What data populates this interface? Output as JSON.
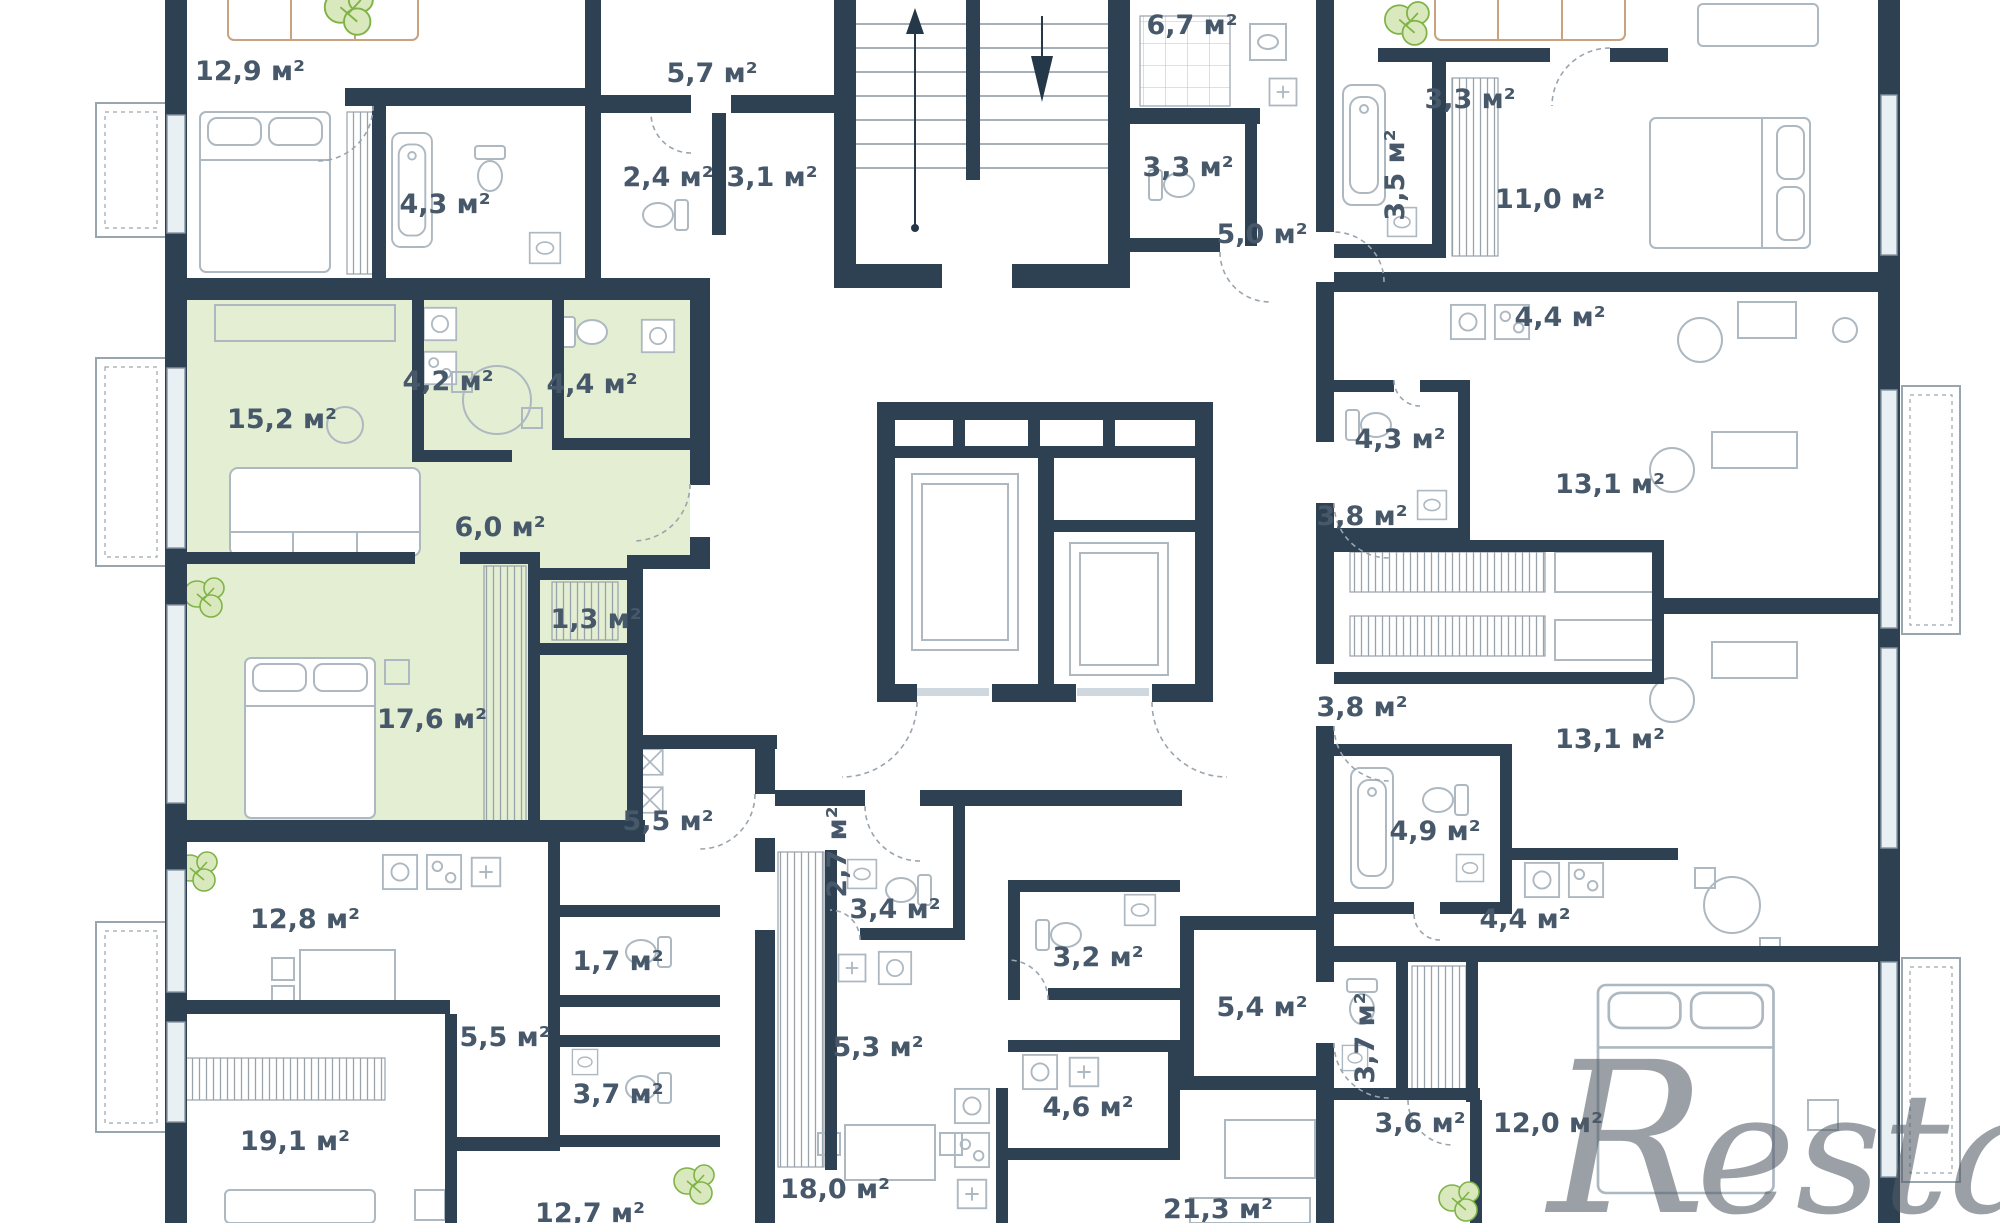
{
  "title": "Residential floor plan",
  "area_unit": "м²",
  "watermark": {
    "r": "R",
    "rest": "estate"
  },
  "colors": {
    "wall": "#2d4152",
    "highlight_apartment": "#e4eed2",
    "label_text": "#46586a",
    "plant_green": "#7fb347",
    "watermark_grey": "#525c66"
  },
  "icons": [
    "plant-icon",
    "stairs-up-arrow-icon",
    "stairs-down-arrow-icon",
    "toilet-icon",
    "sink-icon",
    "washer-icon",
    "stove-icon",
    "bathtub-icon"
  ],
  "rooms": [
    {
      "name": "bedroom-top-left",
      "area": "12,9 м²"
    },
    {
      "name": "hallway-top-left",
      "area": "5,7 м²"
    },
    {
      "name": "bathroom-top-center",
      "area": "6,7 м²"
    },
    {
      "name": "hallway-top-right",
      "area": "3,3 м²"
    },
    {
      "name": "wc-top-left",
      "area": "2,4 м²"
    },
    {
      "name": "hall-top-left",
      "area": "3,1 м²"
    },
    {
      "name": "wc-top-center",
      "area": "3,3 м²"
    },
    {
      "name": "bathroom-top-right",
      "area": "3,5 м²"
    },
    {
      "name": "bedroom-top-right",
      "area": "11,0 м²"
    },
    {
      "name": "bathroom-apt1",
      "area": "4,3 м²"
    },
    {
      "name": "hall-top-center",
      "area": "5,0 м²"
    },
    {
      "name": "kitchen-right-1",
      "area": "4,4 м²"
    },
    {
      "name": "kitchen-green",
      "area": "4,2 м²"
    },
    {
      "name": "bathroom-green",
      "area": "4,4 м²"
    },
    {
      "name": "living-green",
      "area": "15,2 м²"
    },
    {
      "name": "bathroom-right-2",
      "area": "4,3 м²"
    },
    {
      "name": "living-right-1",
      "area": "13,1 м²"
    },
    {
      "name": "hall-right-1",
      "area": "3,8 м²"
    },
    {
      "name": "hall-green",
      "area": "6,0 м²"
    },
    {
      "name": "closet-green",
      "area": "1,3 м²"
    },
    {
      "name": "hall-right-2",
      "area": "3,8 м²"
    },
    {
      "name": "living-right-2",
      "area": "13,1 м²"
    },
    {
      "name": "bedroom-green",
      "area": "17,6 м²"
    },
    {
      "name": "bathroom-right-3",
      "area": "4,9 м²"
    },
    {
      "name": "hallway-left-2",
      "area": "5,5 м²"
    },
    {
      "name": "hall-center-rotated",
      "area": "2,7 м²"
    },
    {
      "name": "kitchen-right-3",
      "area": "4,4 м²"
    },
    {
      "name": "wc-center-1",
      "area": "3,4 м²"
    },
    {
      "name": "bathroom-center",
      "area": "3,2 м²"
    },
    {
      "name": "room-left-2",
      "area": "12,8 м²"
    },
    {
      "name": "wc-left-2",
      "area": "1,7 м²"
    },
    {
      "name": "hall-right-4",
      "area": "5,4 м²"
    },
    {
      "name": "wc-right-4",
      "area": "3,7 м²"
    },
    {
      "name": "hall-center-2",
      "area": "5,3 м²"
    },
    {
      "name": "hall-left-3",
      "area": "5,5 м²"
    },
    {
      "name": "wc-left-3",
      "area": "3,7 м²"
    },
    {
      "name": "wc-center-2",
      "area": "4,6 м²"
    },
    {
      "name": "hall-right-5",
      "area": "3,6 м²"
    },
    {
      "name": "bedroom-right-4",
      "area": "12,0 м²"
    },
    {
      "name": "room-left-4",
      "area": "19,1 м²"
    },
    {
      "name": "kitchen-living-center",
      "area": "18,0 м²"
    },
    {
      "name": "room-center-2",
      "area": "21,3 м²"
    },
    {
      "name": "room-left-5",
      "area": "12,7 м²"
    }
  ]
}
